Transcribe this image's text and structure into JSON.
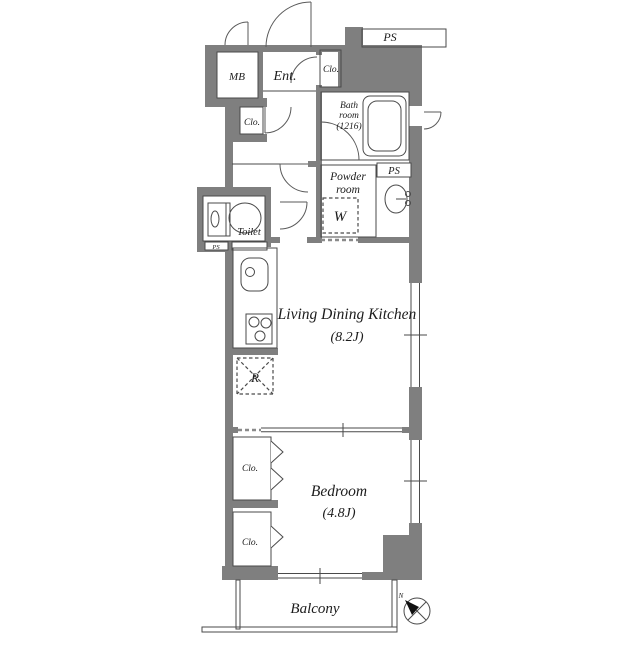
{
  "floorplan": {
    "labels": {
      "mb": "MB",
      "entrance": "Ent.",
      "closet_entrance": "Clo.",
      "ps_top": "PS",
      "bath_line1": "Bath",
      "bath_line2": "room",
      "bath_line3": "(1216)",
      "closet_hall": "Clo.",
      "powder_line1": "Powder",
      "powder_line2": "room",
      "ps_mid": "PS",
      "washer": "W",
      "toilet": "Toilet",
      "ps_small": "PS",
      "ldk_name": "Living Dining Kitchen",
      "ldk_size": "(8.2J)",
      "fridge": "R",
      "bedroom_name": "Bedroom",
      "bedroom_size": "(4.8J)",
      "closet1": "Clo.",
      "closet2": "Clo.",
      "balcony": "Balcony",
      "compass_north": "N"
    },
    "colors": {
      "wall": "#7f7f7f",
      "line": "#4a4a4a",
      "text": "#1c1c1c",
      "background": "#ffffff"
    }
  }
}
